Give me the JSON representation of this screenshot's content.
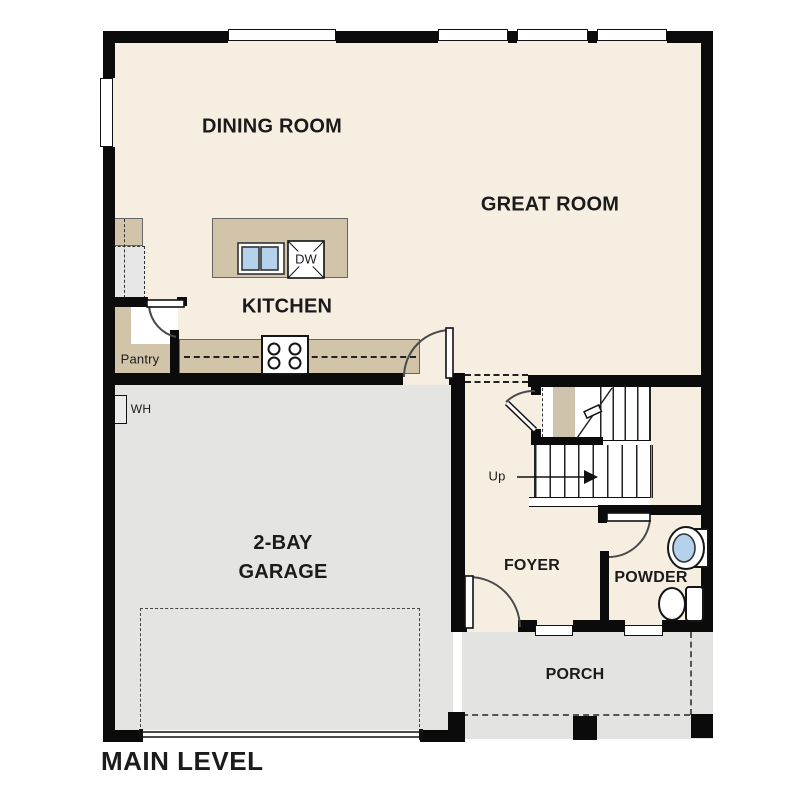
{
  "plan": {
    "title": "MAIN LEVEL",
    "rooms": {
      "dining": {
        "label": "DINING ROOM"
      },
      "great": {
        "label": "GREAT ROOM"
      },
      "kitchen": {
        "label": "KITCHEN"
      },
      "pantry": {
        "label": "Pantry"
      },
      "water_heater": {
        "label": "WH"
      },
      "garage": {
        "label_line1": "2-BAY",
        "label_line2": "GARAGE"
      },
      "foyer": {
        "label": "FOYER"
      },
      "powder": {
        "label": "POWDER"
      },
      "porch": {
        "label": "PORCH"
      }
    },
    "stairs": {
      "direction_label": "Up"
    },
    "appliances": {
      "dishwasher": "DW"
    }
  },
  "colors": {
    "wall": "#0b0b0b",
    "floor": "#f6eee1",
    "cabinet": "#d2c4a9",
    "garage": "#e4e4e2",
    "porch": "#e3e3e1",
    "stairtan": "#cfc3ae",
    "sink": "#b5d2ec"
  }
}
